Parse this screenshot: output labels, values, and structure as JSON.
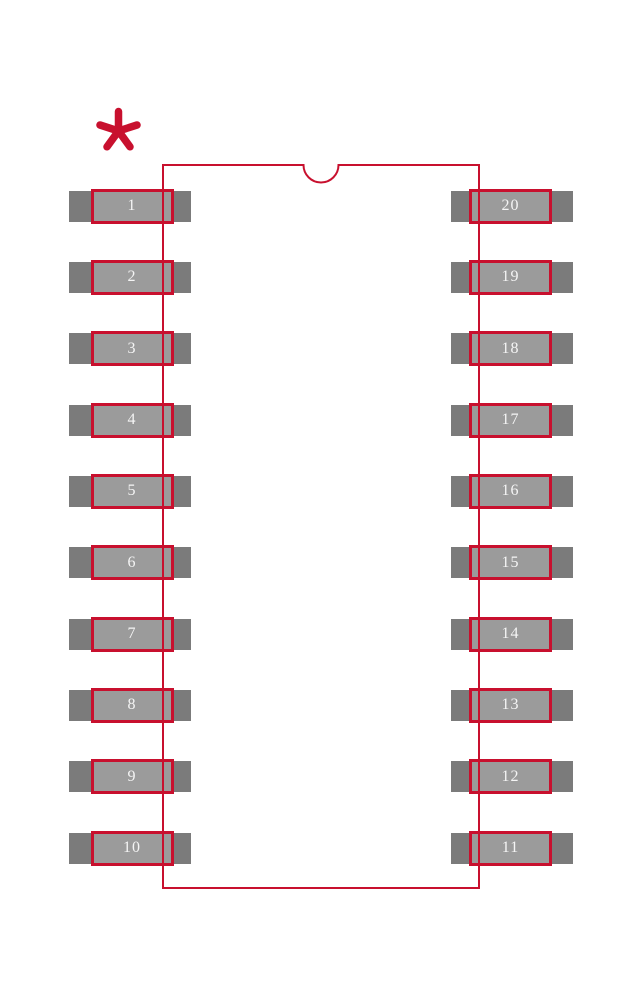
{
  "figure": {
    "description": "20-pad dual-row IC package land pattern (footprint) drawing",
    "pin1_marker": "*"
  },
  "colors": {
    "background": "#ffffff",
    "outline_red": "#c8102e",
    "pad_outer_gray": "#7b7b7b",
    "pad_inner_gray": "#9b9b9b",
    "pin_text": "#f5f5f5"
  },
  "pins": {
    "left": [
      "1",
      "2",
      "3",
      "4",
      "5",
      "6",
      "7",
      "8",
      "9",
      "10"
    ],
    "right": [
      "20",
      "19",
      "18",
      "17",
      "16",
      "15",
      "14",
      "13",
      "12",
      "11"
    ]
  }
}
